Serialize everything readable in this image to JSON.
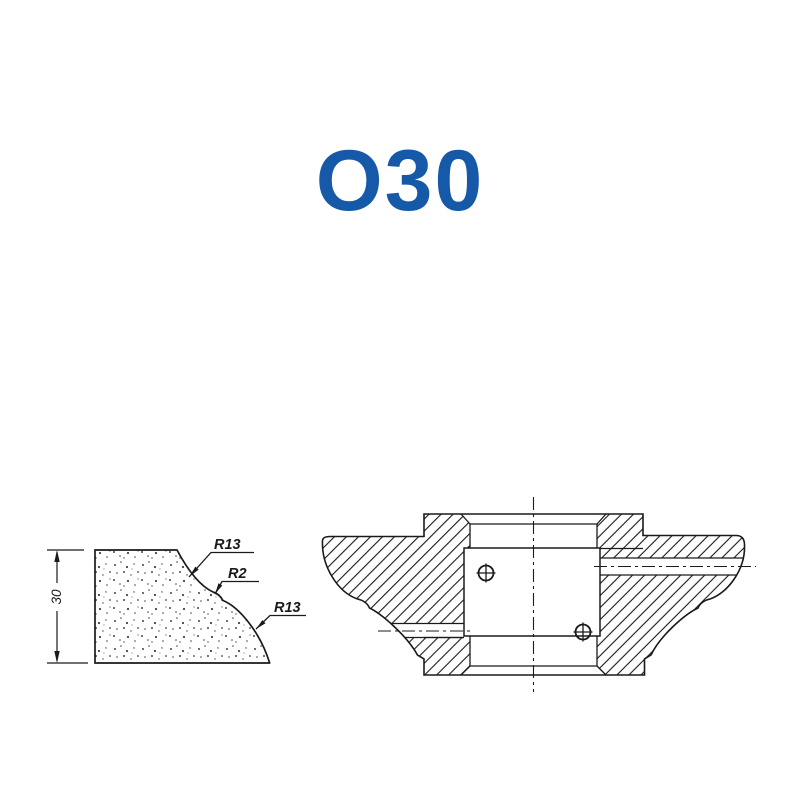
{
  "title": {
    "text": "O30",
    "color": "#1559A8"
  },
  "profile_view": {
    "height_dimension": "30",
    "radius_labels": [
      "R13",
      "R2",
      "R13"
    ]
  },
  "section_view": {
    "description": "cutter head cross-section"
  },
  "colors": {
    "line": "#1a1a1a",
    "background": "#ffffff",
    "accent": "#1559A8"
  }
}
